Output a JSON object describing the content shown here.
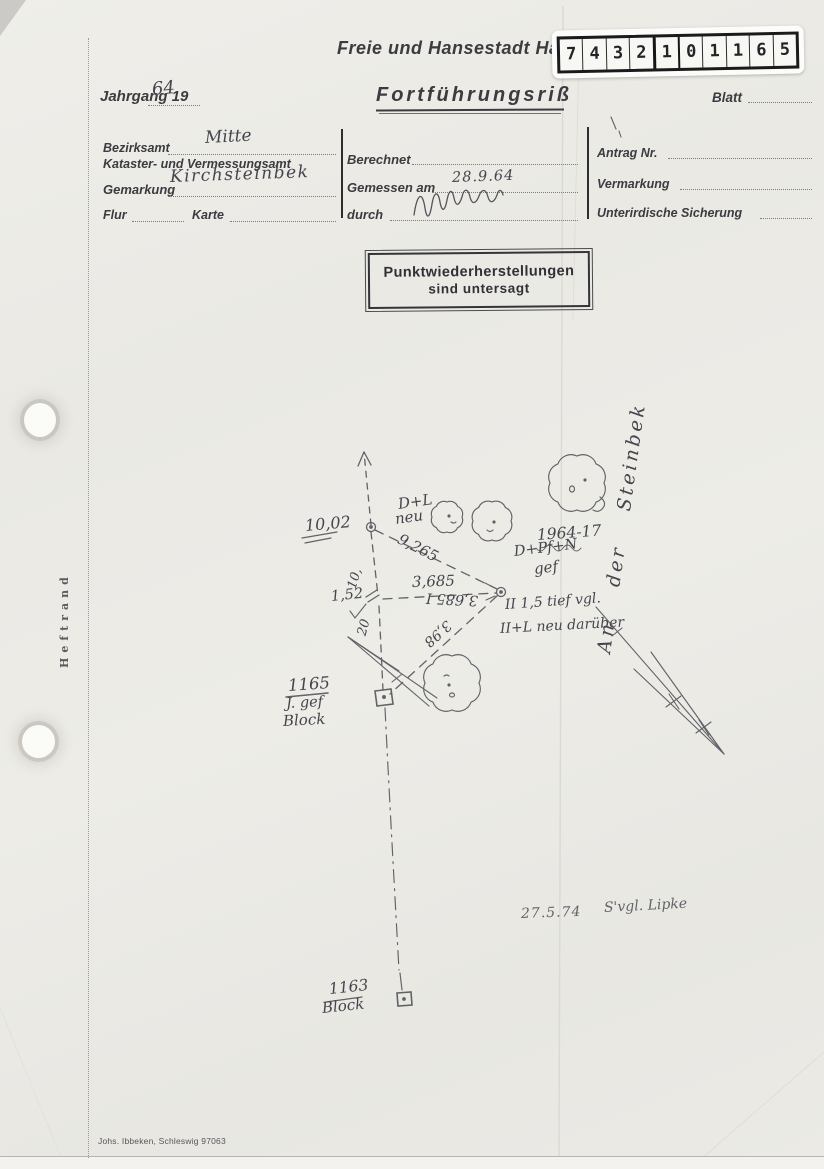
{
  "header": {
    "city_line": "Freie und Hansestadt Ha",
    "sticker_digits": [
      "7",
      "4",
      "3",
      "2",
      "1",
      "0",
      "1",
      "1",
      "6",
      "5"
    ],
    "jahrgang_label": "Jahrgang 19",
    "jahrgang_value": "64",
    "title": "Fortführungsriß",
    "blatt_label": "Blatt"
  },
  "form": {
    "bezirksamt_label": "Bezirksamt",
    "bezirksamt_value": "Mitte",
    "amt_label": "Kataster- und Vermessungsamt",
    "gemarkung_label": "Gemarkung",
    "gemarkung_value": "Kirchsteinbek",
    "flur_label": "Flur",
    "karte_label": "Karte",
    "berechnet_label": "Berechnet",
    "gemessen_label": "Gemessen am",
    "gemessen_value": "28.9.64",
    "durch_label": "durch",
    "antrag_label": "Antrag Nr.",
    "vermarkung_label": "Vermarkung",
    "sicherung_label": "Unterirdische Sicherung"
  },
  "stamp": {
    "line1": "Punktwiederherstellungen",
    "line2": "sind untersagt"
  },
  "margin": {
    "heftrand": "Heftrand",
    "printer": "Johs. Ibbeken, Schleswig 97063"
  },
  "sketch": {
    "street_name": "An der Steinbek",
    "point_a_type": "D+L",
    "point_a_type2": "neu",
    "dist_arrow_a": "10,02",
    "dist_a_b": "9,265",
    "year_ref": "1964-17",
    "point_b_type": "D+Pf+N",
    "point_b_type2": "gef",
    "dist_j_b": "3,685",
    "dist_j_b_reverse": "3,685 I",
    "note_line1": "II 1,5 tief vgl.",
    "note_line2": "II+L neu darüber",
    "offset_j": "1,52",
    "chainage_1": "10,",
    "chainage_2": "20",
    "dist_b_p1165": "3,98",
    "point_1165_id": "1165",
    "point_1165_note": "J. gef",
    "point_1165_type": "Block",
    "point_1163_id": "1163",
    "point_1163_type": "Block",
    "revision_date": "27.5.74",
    "revision_note": "S'vgl. Lipke"
  }
}
